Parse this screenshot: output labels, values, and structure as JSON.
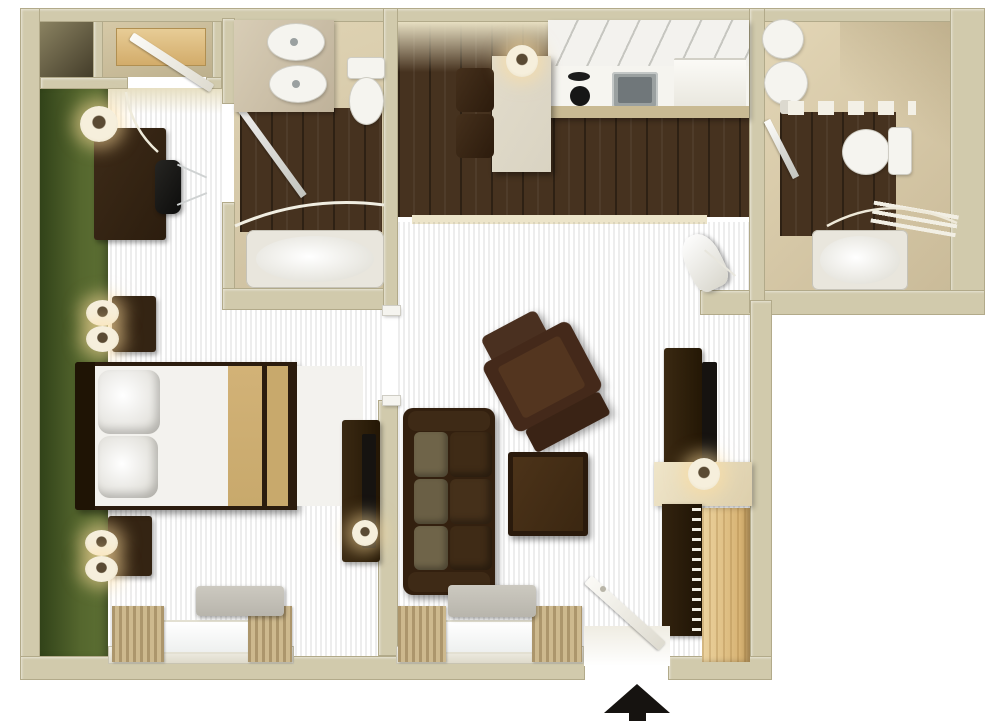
{
  "meta": {
    "type": "3d-floor-plan",
    "view": "top-down",
    "marker": "entry-up-arrow"
  },
  "palette": {
    "bg": "#ffffff",
    "wall": "#d1caac",
    "wallEdge": "#b2aa8a",
    "wallFace": "#e7dfc2",
    "green1": "#2e3f17",
    "green2": "#55672e",
    "bedCarpet1": "#7f6537",
    "bedCarpet2": "#c9ae80",
    "livCarpet1": "#7b6132",
    "livCarpet2": "#a3875a",
    "plank1": "#46321f",
    "plank2": "#2f2113",
    "threshold": "#ece4c9",
    "woodLight1": "#e8cd97",
    "woodLight2": "#d2ab69",
    "furnDark": "#342413",
    "furnMid": "#4a3222",
    "furnSeat": "#53351f",
    "oliveCushion": "#6f6449",
    "bedTan": "#c8a96c",
    "bedFrame": "#2b1c0e",
    "whiteFix": "#f5f4ef",
    "grayFix": "#cfcdc4",
    "steel": "#9aa0a0",
    "steelDark": "#70777a",
    "counterEdge": "#c9ba93",
    "tableCream": "#d9d3c2",
    "curtain": "#cdb98e",
    "acGray": "#b8b5ac",
    "glow": "#ffdf9e",
    "black": "#161310",
    "tub": "#e9e6dd",
    "b2base1": "#e3d6b6",
    "b2base2": "#cabb99"
  },
  "rooms": {
    "bedroom": {
      "label": "bedroom",
      "items": [
        "accent-wall",
        "closet",
        "wardrobe-shelf",
        "closet-door",
        "desk",
        "desk-lamp",
        "desk-chair",
        "nightstand",
        "table-lamps",
        "queen-bed",
        "pillows",
        "media-console",
        "tv",
        "window",
        "curtains",
        "ac-unit"
      ]
    },
    "bathroom_main": {
      "label": "bathroom",
      "items": [
        "vanity",
        "double-sink",
        "toilet",
        "bathtub",
        "shower-rod",
        "glass-door"
      ]
    },
    "kitchen": {
      "label": "kitchen-dining",
      "items": [
        "dining-table",
        "dining-chairs",
        "pendant-light",
        "upper-cabinets",
        "stove",
        "sink",
        "dishwasher"
      ]
    },
    "living_room": {
      "label": "living-room",
      "items": [
        "sofa",
        "recliner",
        "coffee-table",
        "media-console",
        "tv",
        "ironing-board",
        "window",
        "curtains",
        "ac-unit",
        "entry-door"
      ]
    },
    "bathroom_second": {
      "label": "bathroom-2",
      "items": [
        "pedestal-sink",
        "toilet",
        "bathtub",
        "shower-door",
        "towel-rack",
        "louver-door",
        "door-swing-arc"
      ]
    },
    "entry_closet": {
      "label": "closet",
      "items": [
        "counter",
        "lamp",
        "hanging-rod",
        "hangers",
        "wood-floor-panel"
      ]
    }
  },
  "entry": {
    "marker": "up-arrow",
    "color": "#161310"
  }
}
